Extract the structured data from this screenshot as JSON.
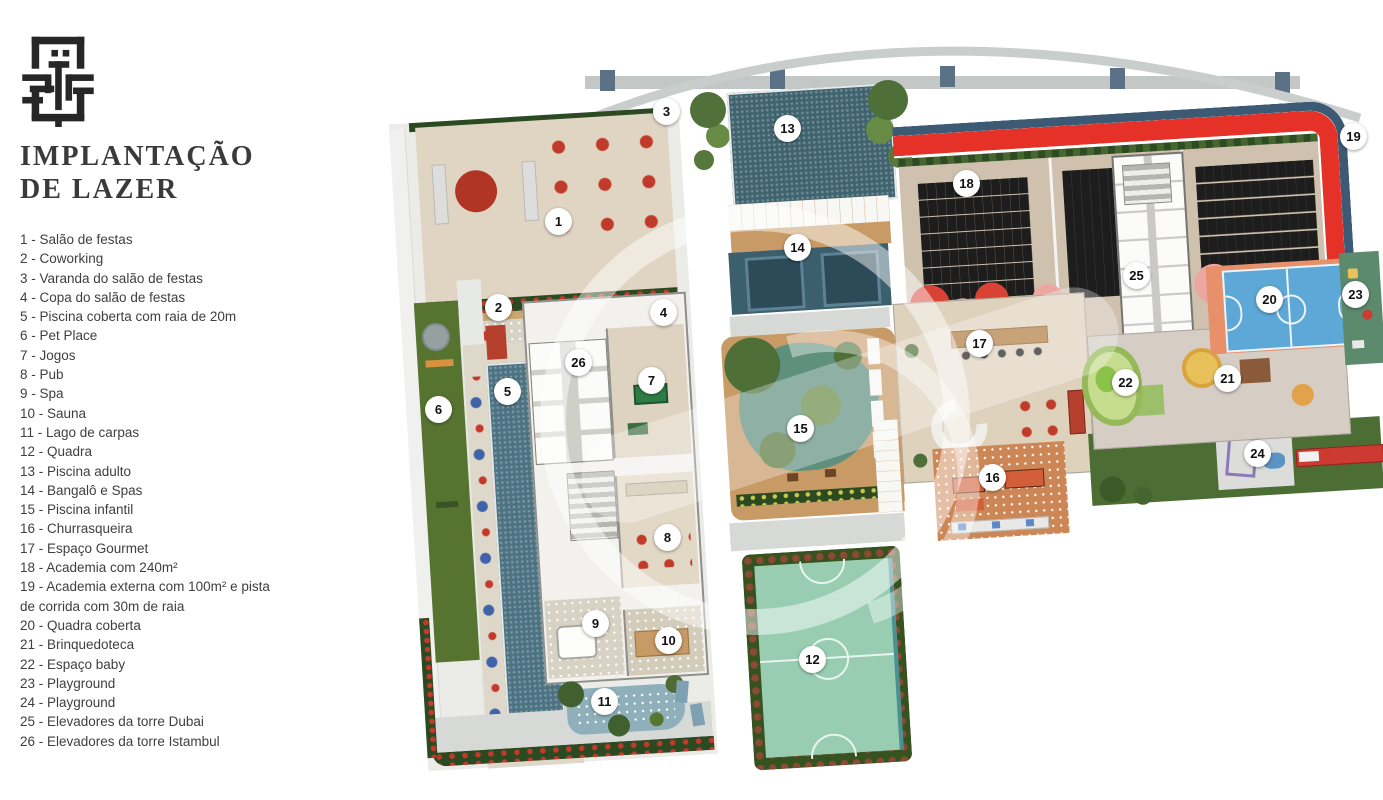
{
  "sidebar": {
    "title_line1": "IMPLANTAÇÃO",
    "title_line2": "DE LAZER",
    "legend": [
      {
        "num": "1",
        "label": "Salão de festas"
      },
      {
        "num": "2",
        "label": "Coworking"
      },
      {
        "num": "3",
        "label": "Varanda do salão de festas"
      },
      {
        "num": "4",
        "label": "Copa do salão de festas"
      },
      {
        "num": "5",
        "label": "Piscina coberta com raia de 20m"
      },
      {
        "num": "6",
        "label": "Pet Place"
      },
      {
        "num": "7",
        "label": "Jogos"
      },
      {
        "num": "8",
        "label": "Pub"
      },
      {
        "num": "9",
        "label": "Spa"
      },
      {
        "num": "10",
        "label": "Sauna"
      },
      {
        "num": "11",
        "label": "Lago de carpas"
      },
      {
        "num": "12",
        "label": "Quadra"
      },
      {
        "num": "13",
        "label": "Piscina adulto"
      },
      {
        "num": "14",
        "label": "Bangalô e Spas"
      },
      {
        "num": "15",
        "label": "Piscina infantil"
      },
      {
        "num": "16",
        "label": "Churrasqueira"
      },
      {
        "num": "17",
        "label": "Espaço Gourmet"
      },
      {
        "num": "18",
        "label": "Academia com 240m²"
      },
      {
        "num": "19",
        "label": "Academia externa com 100m² e pista de corrida com 30m de raia"
      },
      {
        "num": "20",
        "label": "Quadra coberta"
      },
      {
        "num": "21",
        "label": "Brinquedoteca"
      },
      {
        "num": "22",
        "label": "Espaço baby"
      },
      {
        "num": "23",
        "label": "Playground"
      },
      {
        "num": "24",
        "label": "Playground"
      },
      {
        "num": "25",
        "label": "Elevadores da torre Dubai"
      },
      {
        "num": "26",
        "label": "Elevadores da torre Istambul"
      }
    ]
  },
  "plan": {
    "markers": [
      {
        "n": "1",
        "x": 168,
        "y": 191
      },
      {
        "n": "2",
        "x": 108,
        "y": 277
      },
      {
        "n": "3",
        "x": 276,
        "y": 81
      },
      {
        "n": "4",
        "x": 273,
        "y": 282
      },
      {
        "n": "5",
        "x": 117,
        "y": 361
      },
      {
        "n": "6",
        "x": 48,
        "y": 379
      },
      {
        "n": "7",
        "x": 261,
        "y": 350
      },
      {
        "n": "8",
        "x": 277,
        "y": 507
      },
      {
        "n": "9",
        "x": 205,
        "y": 593
      },
      {
        "n": "10",
        "x": 278,
        "y": 610
      },
      {
        "n": "11",
        "x": 214,
        "y": 671
      },
      {
        "n": "12",
        "x": 422,
        "y": 629
      },
      {
        "n": "13",
        "x": 397,
        "y": 98
      },
      {
        "n": "14",
        "x": 407,
        "y": 217
      },
      {
        "n": "15",
        "x": 410,
        "y": 398
      },
      {
        "n": "16",
        "x": 602,
        "y": 447
      },
      {
        "n": "17",
        "x": 589,
        "y": 313
      },
      {
        "n": "18",
        "x": 576,
        "y": 153
      },
      {
        "n": "19",
        "x": 963,
        "y": 106
      },
      {
        "n": "20",
        "x": 879,
        "y": 269
      },
      {
        "n": "21",
        "x": 837,
        "y": 348
      },
      {
        "n": "22",
        "x": 735,
        "y": 352
      },
      {
        "n": "23",
        "x": 965,
        "y": 264
      },
      {
        "n": "24",
        "x": 867,
        "y": 423
      },
      {
        "n": "25",
        "x": 746,
        "y": 245
      },
      {
        "n": "26",
        "x": 188,
        "y": 332
      }
    ]
  },
  "palette": {
    "title_color": "#3a3a3a",
    "text_color": "#3f3f3f",
    "marker_bg": "#ffffff",
    "marker_text": "#111111",
    "hedge": "#2c4a21",
    "lawn": "#567430",
    "track_red": "#e53127",
    "track_blue": "#3c5a74",
    "pool": "#4d7383",
    "pool_dark": "#40646f",
    "kids_pool": "#5f8f7d",
    "court12": "#98cdb2",
    "court20": "#5da8d7",
    "court20_surround": "#e8906a",
    "deck_beige": "#e0d5c3",
    "wood": "#c89a66",
    "terracotta": "#cd8757",
    "path_gray": "#d7d9d6",
    "gym_floor": "#cfc1ae"
  }
}
